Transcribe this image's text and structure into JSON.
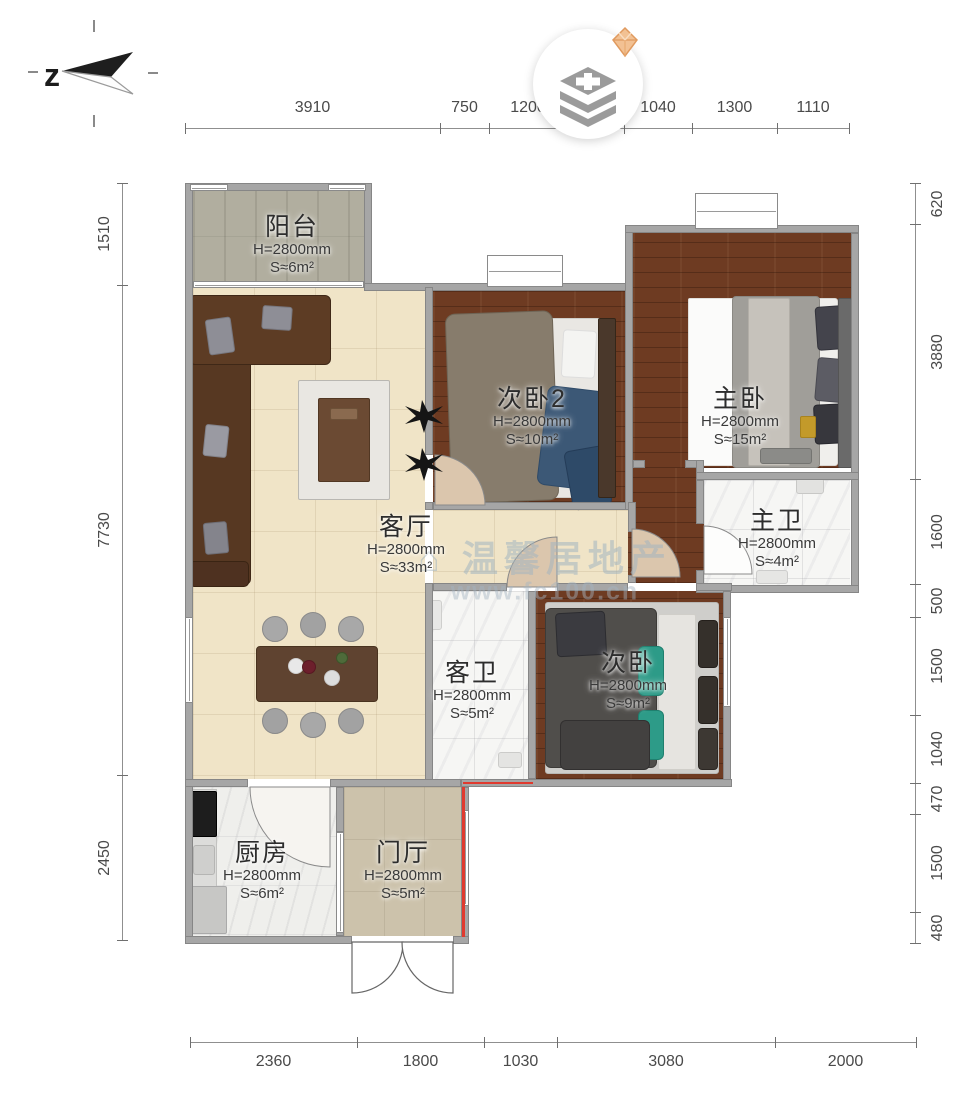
{
  "compass": {
    "label": "z"
  },
  "badge": {
    "icon": "layers-plus-icon",
    "gem": "diamond-gem-icon"
  },
  "watermark": {
    "brand": "⌂ 温馨居地产",
    "url": "www.fc100.cn"
  },
  "dimensions": {
    "top": [
      "3910",
      "750",
      "1200",
      "",
      "1040",
      "1300",
      "1110"
    ],
    "left": [
      "1510",
      "7730",
      "2450"
    ],
    "right": [
      "620",
      "3880",
      "1600",
      "500",
      "1500",
      "1040",
      "470",
      "1500",
      "480"
    ],
    "bottom": [
      "2360",
      "1800",
      "1030",
      "3080",
      "2000"
    ]
  },
  "rooms": [
    {
      "id": "balcony",
      "name": "阳台",
      "height": "H=2800mm",
      "area": "S≈6m²"
    },
    {
      "id": "bedroom2",
      "name": "次卧2",
      "height": "H=2800mm",
      "area": "S≈10m²"
    },
    {
      "id": "master-bedroom",
      "name": "主卧",
      "height": "H=2800mm",
      "area": "S≈15m²"
    },
    {
      "id": "living-room",
      "name": "客厅",
      "height": "H=2800mm",
      "area": "S≈33m²"
    },
    {
      "id": "master-bath",
      "name": "主卫",
      "height": "H=2800mm",
      "area": "S≈4m²"
    },
    {
      "id": "guest-bath",
      "name": "客卫",
      "height": "H=2800mm",
      "area": "S≈5m²"
    },
    {
      "id": "bedroom3",
      "name": "次卧",
      "height": "H=2800mm",
      "area": "S≈9m²"
    },
    {
      "id": "kitchen",
      "name": "厨房",
      "height": "H=2800mm",
      "area": "S≈6m²"
    },
    {
      "id": "foyer",
      "name": "门厅",
      "height": "H=2800mm",
      "area": "S≈5m²"
    }
  ]
}
